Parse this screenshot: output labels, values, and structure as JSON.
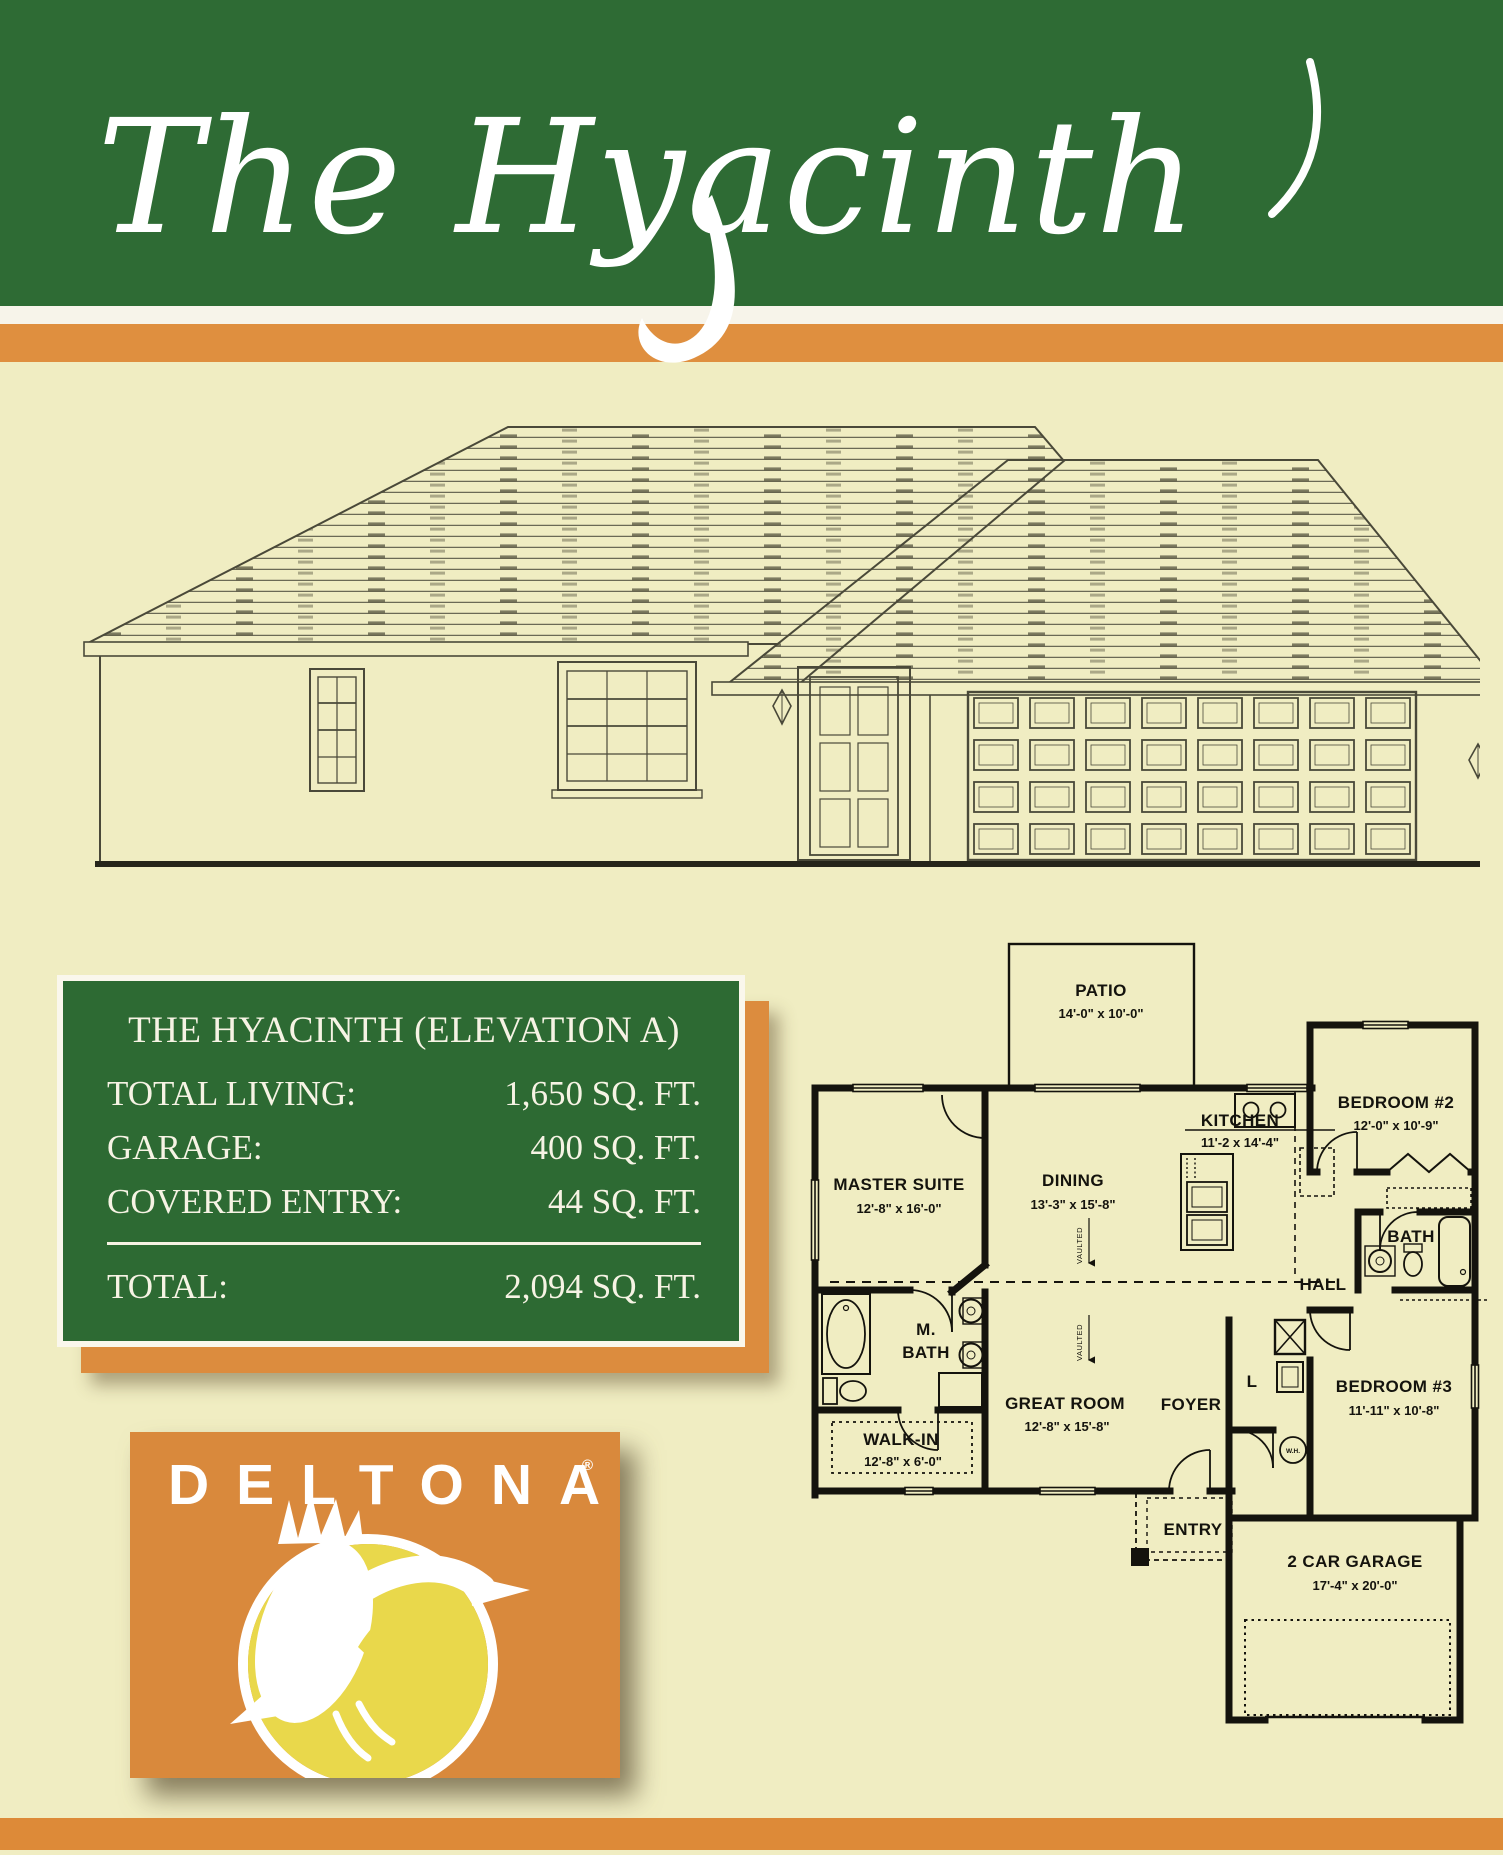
{
  "header": {
    "title": "The Hyacinth"
  },
  "spec": {
    "title": "THE HYACINTH (ELEVATION A)",
    "rows": [
      {
        "label": "TOTAL LIVING:",
        "value": "1,650 SQ. FT."
      },
      {
        "label": "GARAGE:",
        "value": "400 SQ. FT."
      },
      {
        "label": "COVERED ENTRY:",
        "value": "44 SQ. FT."
      }
    ],
    "total_label": "TOTAL:",
    "total_value": "2,094 SQ. FT."
  },
  "plan": {
    "patio": {
      "name": "PATIO",
      "dims": "14'-0\" x 10'-0\""
    },
    "master_suite": {
      "name": "MASTER SUITE",
      "dims": "12'-8\" x 16'-0\""
    },
    "dining": {
      "name": "DINING",
      "dims": "13'-3\" x 15'-8\""
    },
    "kitchen": {
      "name": "KITCHEN",
      "dims": "11'-2 x 14'-4\""
    },
    "bedroom2": {
      "name": "BEDROOM #2",
      "dims": "12'-0\" x 10'-9\""
    },
    "bath": {
      "name": "BATH"
    },
    "hall": {
      "name": "HALL"
    },
    "m_bath": {
      "line1": "M.",
      "line2": "BATH"
    },
    "walk_in": {
      "name": "WALK-IN",
      "dims": "12'-8\" x 6'-0\""
    },
    "great_room": {
      "name": "GREAT ROOM",
      "dims": "12'-8\" x 15'-8\""
    },
    "foyer": {
      "name": "FOYER"
    },
    "linen": {
      "name": "L"
    },
    "water_heater": {
      "name": "W.H."
    },
    "bedroom3": {
      "name": "BEDROOM #3",
      "dims": "11'-11\" x 10'-8\""
    },
    "entry": {
      "name": "ENTRY"
    },
    "garage": {
      "name": "2 CAR GARAGE",
      "dims": "17'-4\" x 20'-0\""
    },
    "vaulted": "VAULTED"
  },
  "logo": {
    "brand": "DELTONA",
    "registered": "®"
  },
  "colors": {
    "banner_green": "#2e6b34",
    "stripe_orange": "#df8f3f",
    "page_cream": "#f0edc2",
    "spec_green": "#2d6a33",
    "spec_shadow_orange": "#dc8c3e",
    "logo_orange": "#d9893c",
    "logo_yellow": "#e9d84b"
  }
}
